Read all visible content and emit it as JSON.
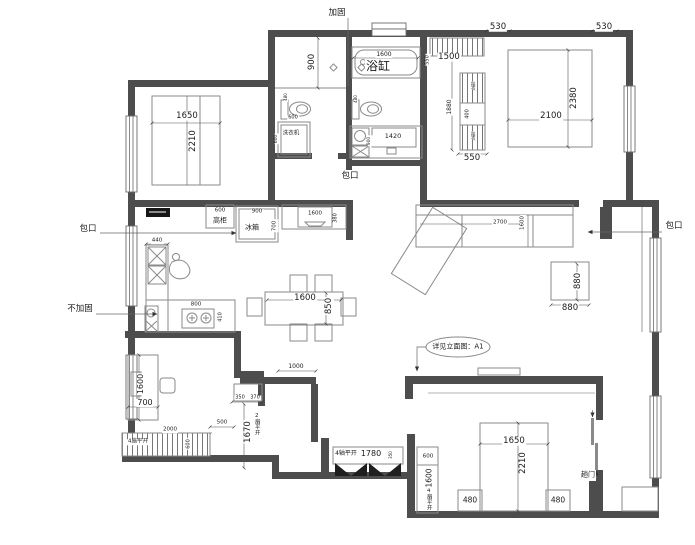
{
  "colors": {
    "wall": "#4d4d4d",
    "line": "#8a8a8a",
    "dimline": "#555555",
    "dimtext": "#1b1b1b",
    "hatch": "#777777",
    "chip": "#161616"
  },
  "plan": {
    "annotations": [
      {
        "n": "jiagu-label",
        "t": "加固",
        "x": 337,
        "y": 13,
        "s": 8.5
      },
      {
        "n": "bathtub-label",
        "t": "浴缸",
        "x": 378,
        "y": 66,
        "s": 12
      },
      {
        "n": "baokou-bath-label",
        "t": "包口",
        "x": 350,
        "y": 176,
        "s": 8.5
      },
      {
        "n": "baokou-kitchen-label",
        "t": "包口",
        "x": 88,
        "y": 229,
        "s": 8.5
      },
      {
        "n": "baokou-living-label",
        "t": "包口",
        "x": 674,
        "y": 226,
        "s": 8.5
      },
      {
        "n": "bujiagu-label",
        "t": "不加固",
        "x": 80,
        "y": 309,
        "s": 8.5
      },
      {
        "n": "tall-cabinet-label",
        "t": "高柜",
        "x": 220,
        "y": 221,
        "s": 7
      },
      {
        "n": "fridge-label",
        "t": "冰箱",
        "x": 252,
        "y": 228,
        "s": 7
      },
      {
        "n": "washer-label",
        "t": "洗衣机",
        "x": 291,
        "y": 134,
        "s": 5.5
      },
      {
        "n": "elevation-note-label",
        "t": "详见立面图：A1",
        "x": 458,
        "y": 347,
        "s": 7
      },
      {
        "n": "sliding-door-label",
        "t": "趟门",
        "x": 588,
        "y": 475,
        "s": 7
      },
      {
        "n": "wardrobe-swing4-label",
        "t": "4扇平开",
        "x": 138,
        "y": 442,
        "s": 5.5
      },
      {
        "n": "door-swing2-label",
        "t": "2扇平开",
        "x": 256,
        "y": 424,
        "s": 5.5,
        "v": true
      },
      {
        "n": "entry-swing4-label",
        "t": "4轴平开",
        "x": 346,
        "y": 454,
        "s": 6
      },
      {
        "n": "corridor-swing4-label",
        "t": "4扇平开",
        "x": 428,
        "y": 499,
        "s": 5.5,
        "v": true
      },
      {
        "n": "closet-tag-top",
        "t": "挂衣",
        "x": 472,
        "y": 86,
        "s": 4.5,
        "v": true
      },
      {
        "n": "closet-tag-bottom",
        "t": "挂衣",
        "x": 472,
        "y": 136,
        "s": 4.5,
        "v": true
      },
      {
        "n": "dim-1650-bed1",
        "t": "1650",
        "x": 187,
        "y": 116,
        "s": 8.5
      },
      {
        "n": "dim-2210-bed1",
        "t": "2210",
        "x": 193,
        "y": 141,
        "s": 8.5,
        "r": true
      },
      {
        "n": "dim-900-bath",
        "t": "900",
        "x": 312,
        "y": 62,
        "s": 8.5,
        "r": true
      },
      {
        "n": "dim-1600-tub",
        "t": "1600",
        "x": 384,
        "y": 55,
        "s": 6
      },
      {
        "n": "dim-1420-vanity",
        "t": "1420",
        "x": 393,
        "y": 136,
        "s": 6.5
      },
      {
        "n": "dim-900-vanity",
        "t": "900",
        "x": 370,
        "y": 141,
        "s": 4.5,
        "r": true
      },
      {
        "n": "dim-480-toilet1",
        "t": "480",
        "x": 286,
        "y": 97,
        "s": 4,
        "r": true
      },
      {
        "n": "dim-480-toilet2",
        "t": "480",
        "x": 356,
        "y": 99,
        "s": 4,
        "r": true
      },
      {
        "n": "dim-600-washer",
        "t": "600",
        "x": 293,
        "y": 118,
        "s": 5
      },
      {
        "n": "dim-600-washer-v",
        "t": "600",
        "x": 277,
        "y": 139,
        "s": 4.5,
        "r": true
      },
      {
        "n": "dim-530-a",
        "t": "530",
        "x": 498,
        "y": 27,
        "s": 8.5
      },
      {
        "n": "dim-530-b",
        "t": "530",
        "x": 604,
        "y": 27,
        "s": 8.5
      },
      {
        "n": "dim-1500-closet",
        "t": "1500",
        "x": 449,
        "y": 57,
        "s": 8.5
      },
      {
        "n": "dim-550-closet-v",
        "t": "550",
        "x": 428,
        "y": 60,
        "s": 5,
        "r": true
      },
      {
        "n": "dim-1880-closet",
        "t": "1880",
        "x": 450,
        "y": 107,
        "s": 6,
        "r": true
      },
      {
        "n": "dim-400-closet",
        "t": "400",
        "x": 468,
        "y": 114,
        "s": 5,
        "r": true
      },
      {
        "n": "dim-550-closet",
        "t": "550",
        "x": 472,
        "y": 158,
        "s": 8.5
      },
      {
        "n": "dim-2100-bed2",
        "t": "2100",
        "x": 551,
        "y": 116,
        "s": 8.5
      },
      {
        "n": "dim-2380-bed2",
        "t": "2380",
        "x": 574,
        "y": 98,
        "s": 8.5,
        "r": true
      },
      {
        "n": "dim-600-tallcab",
        "t": "600",
        "x": 220,
        "y": 211,
        "s": 5.5
      },
      {
        "n": "dim-900-fridge",
        "t": "900",
        "x": 257,
        "y": 212,
        "s": 5.5
      },
      {
        "n": "dim-700-fridge",
        "t": "700",
        "x": 275,
        "y": 226,
        "s": 5.5,
        "r": true
      },
      {
        "n": "dim-1600-tvcab",
        "t": "1600",
        "x": 315,
        "y": 214,
        "s": 5.5
      },
      {
        "n": "dim-380-tvcab",
        "t": "380",
        "x": 336,
        "y": 218,
        "s": 5,
        "r": true
      },
      {
        "n": "dim-440-sink",
        "t": "440",
        "x": 157,
        "y": 241,
        "s": 5.5
      },
      {
        "n": "dim-800-stove",
        "t": "800",
        "x": 196,
        "y": 305,
        "s": 5.5
      },
      {
        "n": "dim-410-stove",
        "t": "410",
        "x": 221,
        "y": 317,
        "s": 5,
        "r": true
      },
      {
        "n": "dim-1600-dining",
        "t": "1600",
        "x": 305,
        "y": 298,
        "s": 8.5
      },
      {
        "n": "dim-850-dining",
        "t": "850",
        "x": 329,
        "y": 306,
        "s": 8.5,
        "r": true
      },
      {
        "n": "dim-2700-sofa",
        "t": "2700",
        "x": 500,
        "y": 223,
        "s": 5.5
      },
      {
        "n": "dim-1600-sofa",
        "t": "1600",
        "x": 523,
        "y": 223,
        "s": 5.5,
        "r": true
      },
      {
        "n": "dim-880-table-v",
        "t": "880",
        "x": 578,
        "y": 281,
        "s": 8.5,
        "r": true
      },
      {
        "n": "dim-880-table",
        "t": "880",
        "x": 570,
        "y": 308,
        "s": 8.5
      },
      {
        "n": "dim-1000-console",
        "t": "1000",
        "x": 296,
        "y": 367,
        "s": 6
      },
      {
        "n": "dim-350-niche",
        "t": "350",
        "x": 240,
        "y": 398,
        "s": 5
      },
      {
        "n": "dim-370-niche",
        "t": "370",
        "x": 255,
        "y": 398,
        "s": 5
      },
      {
        "n": "dim-1670-door",
        "t": "1670",
        "x": 248,
        "y": 432,
        "s": 8.5,
        "r": true
      },
      {
        "n": "dim-500",
        "t": "500",
        "x": 222,
        "y": 423,
        "s": 5.5
      },
      {
        "n": "dim-2000-wardrobe",
        "t": "2000",
        "x": 170,
        "y": 430,
        "s": 5.5
      },
      {
        "n": "dim-600-wardrobe",
        "t": "600",
        "x": 189,
        "y": 444,
        "s": 5,
        "r": true
      },
      {
        "n": "dim-1780-shoe",
        "t": "1780",
        "x": 371,
        "y": 454,
        "s": 8
      },
      {
        "n": "dim-350-shoe",
        "t": "350",
        "x": 391,
        "y": 455,
        "s": 4,
        "r": true
      },
      {
        "n": "dim-600-cwardrobe",
        "t": "600",
        "x": 428,
        "y": 457,
        "s": 5.5
      },
      {
        "n": "dim-1600-cwardrobe",
        "t": "1600",
        "x": 429,
        "y": 478,
        "s": 7.5,
        "r": true
      },
      {
        "n": "dim-1650-bed3",
        "t": "1650",
        "x": 514,
        "y": 441,
        "s": 8.5
      },
      {
        "n": "dim-2210-bed3",
        "t": "2210",
        "x": 523,
        "y": 463,
        "s": 8.5,
        "r": true
      },
      {
        "n": "dim-480-nightstand-a",
        "t": "480",
        "x": 470,
        "y": 500,
        "s": 7.5
      },
      {
        "n": "dim-480-nightstand-b",
        "t": "480",
        "x": 558,
        "y": 500,
        "s": 7.5
      },
      {
        "n": "dim-1600-desk",
        "t": "1600",
        "x": 141,
        "y": 384,
        "s": 8,
        "r": true
      },
      {
        "n": "dim-700-desk",
        "t": "700",
        "x": 145,
        "y": 403,
        "s": 8
      }
    ]
  }
}
